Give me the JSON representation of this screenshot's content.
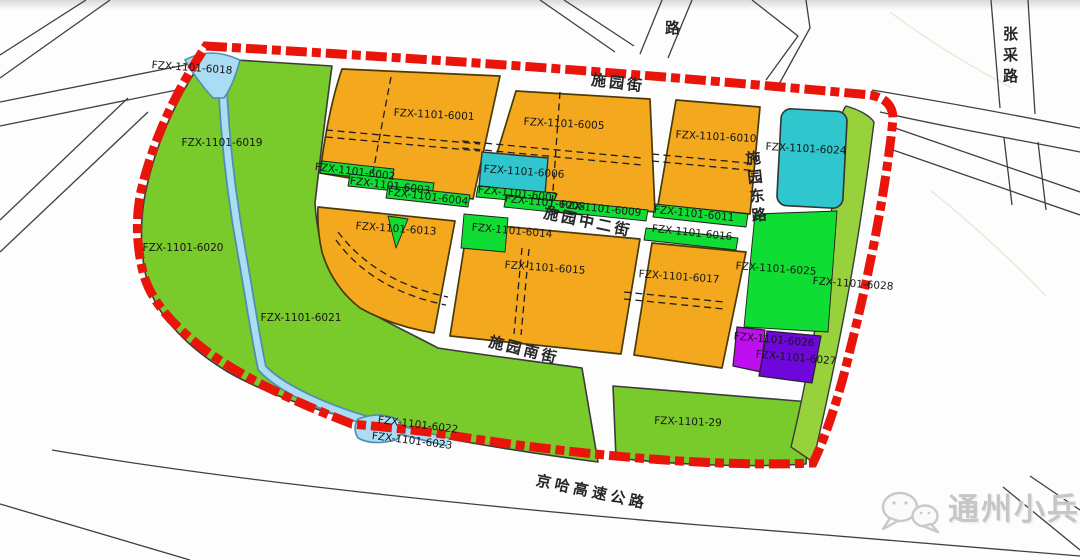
{
  "map_title": "planning-parcel-map",
  "colors": {
    "boundary_red": "#e9150b",
    "park_green": "#79ca2b",
    "strip_green": "#10dd33",
    "light_green": "#97d13c",
    "residential_orange": "#f3a81e",
    "cyan_parcel": "#30c6cd",
    "magenta_parcel": "#bd0ff0",
    "violet_parcel": "#6e07da",
    "water_blue": "#aadcf4",
    "road_line": "#3f3f3f"
  },
  "parcels": [
    {
      "label": "FZX-1101-6018"
    },
    {
      "label": "FZX-1101-6019"
    },
    {
      "label": "FZX-1101-6020"
    },
    {
      "label": "FZX-1101-6021"
    },
    {
      "label": "FZX-1101-6001"
    },
    {
      "label": "FZX-1101-6002"
    },
    {
      "label": "FZX-1101-6003"
    },
    {
      "label": "FZX-1101-6004"
    },
    {
      "label": "FZX-1101-6005"
    },
    {
      "label": "FZX-1101-6006"
    },
    {
      "label": "FZX-1101-6007"
    },
    {
      "label": "FZX-1101-6008"
    },
    {
      "label": "FZX-1101-6009"
    },
    {
      "label": "FZX-1101-6010"
    },
    {
      "label": "FZX-1101-6011"
    },
    {
      "label": "FZX-1101-6013"
    },
    {
      "label": "FZX-1101-6014"
    },
    {
      "label": "FZX-1101-6015"
    },
    {
      "label": "FZX-1101-6016"
    },
    {
      "label": "FZX-1101-6017"
    },
    {
      "label": "FZX-1101-6022"
    },
    {
      "label": "FZX-1101-6023"
    },
    {
      "label": "FZX-1101-6024"
    },
    {
      "label": "FZX-1101-6025"
    },
    {
      "label": "FZX-1101-6026"
    },
    {
      "label": "FZX-1101-6027"
    },
    {
      "label": "FZX-1101-6028"
    },
    {
      "label": "FZX-1101-29"
    }
  ],
  "streets": {
    "shiyuan_jie": "施园街",
    "shiyuan_zhong2_jie": "施园中二街",
    "shiyuan_nan_jie": "施园南街",
    "shiyuan_dong_lu": "施园东路",
    "jingha_expressway": "京哈高速公路",
    "zhangcai_lu": "张采路",
    "partial_road": "路"
  },
  "watermark": {
    "text": "通州小兵",
    "icon": "wechat-icon"
  }
}
